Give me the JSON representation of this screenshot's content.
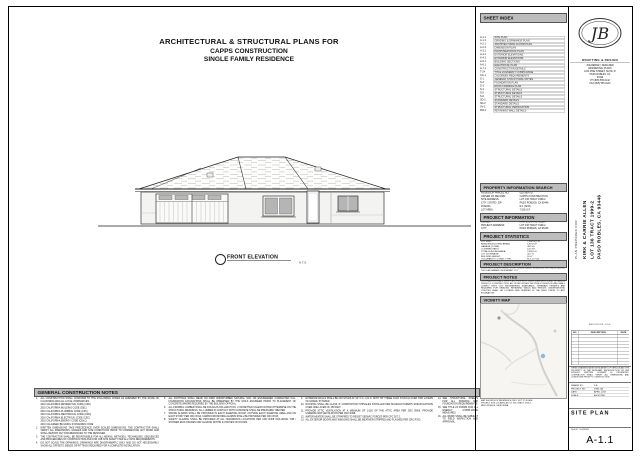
{
  "title_block": {
    "line1": "ARCHITECTURAL & STRUCTURAL PLANS FOR",
    "line2": "CAPPS CONSTRUCTION",
    "line3": "SINGLE FAMILY RESIDENCE"
  },
  "elevation": {
    "label": "FRONT ELEVATION",
    "scale_note": "N.T.S."
  },
  "sheet_index": {
    "header": "SHEET INDEX",
    "rows": [
      {
        "no": "A-1.1",
        "title": "SITE PLAN"
      },
      {
        "no": "A-1.2",
        "title": "GRADING & DRAINAGE PLAN"
      },
      {
        "no": "A-2.1",
        "title": "ARCHITECTURAL FLOOR PLAN"
      },
      {
        "no": "A-2.2",
        "title": "DIMENSION PLAN"
      },
      {
        "no": "A-3.1",
        "title": "PROPOSED ROOF PLAN"
      },
      {
        "no": "A-4.1",
        "title": "EXTERIOR ELEVATIONS"
      },
      {
        "no": "A-4.2",
        "title": "EXTERIOR ELEVATIONS"
      },
      {
        "no": "A-5.1",
        "title": "BUILDING SECTIONS"
      },
      {
        "no": "A-6.1",
        "title": "ELECTRICAL PLAN"
      },
      {
        "no": "A-7.1",
        "title": "CONSTRUCTION DETAILS"
      },
      {
        "no": "T-24",
        "title": "TITLE 24 ENERGY COMPLIANCE"
      },
      {
        "no": "CG-1",
        "title": "CALGREEN REQUIREMENTS"
      },
      {
        "no": "S-1",
        "title": "GENERAL STRUCTURAL NOTES"
      },
      {
        "no": "S-2",
        "title": "FOUNDATION PLAN"
      },
      {
        "no": "S-3",
        "title": "ROOF FRAMING PLAN"
      },
      {
        "no": "S-4",
        "title": "STRUCTURAL DETAILS"
      },
      {
        "no": "S-5",
        "title": "STRUCTURAL DETAILS"
      },
      {
        "no": "S-6",
        "title": "STRUCTURAL DETAILS"
      },
      {
        "no": "SD-1",
        "title": "STANDARD DETAILS"
      },
      {
        "no": "SD-2",
        "title": "STANDARD DETAILS"
      },
      {
        "no": "SV-1",
        "title": "STRUCTURAL VERIFICATION"
      },
      {
        "no": "RW-1",
        "title": "RETAINING WALL DETAILS"
      }
    ]
  },
  "logo": {
    "monogram": "JB",
    "firm": "DRAFTING & DESIGN",
    "address": "JOE BERKEY, DESIGNER\nRESIDENTIAL PLANS\n1234 PINE STREET, SUITE 'D'\nPASO ROBLES, CA\n93446\nPH (805) 555-0142\nFAX (805) 555-0143"
  },
  "prepared_for": {
    "label": "PLAN PREPARED FOR",
    "lines": [
      "KIRK & CARRIE ALLEN",
      "LOT 136 TRACT 1999-2",
      "PASO ROBLES, CA 93446"
    ]
  },
  "property_search": {
    "header": "PROPERTY INFORMATION SEARCH",
    "rows": [
      {
        "label": "ASSESSOR PARCEL NO:",
        "value": "025-380-017"
      },
      {
        "label": "OWNER OF RECORD:",
        "value": "CAPPS CONSTRUCTION"
      },
      {
        "label": "SITE ADDRESS:",
        "value": "LOT 136 TRACT 1999-2"
      },
      {
        "label": "CITY / STATE / ZIP:",
        "value": "PASO ROBLES, CA 93446"
      },
      {
        "label": "ZONING:",
        "value": "R-1 (SFR)"
      },
      {
        "label": "LOT AREA:",
        "value": "7,500 S.F."
      }
    ]
  },
  "project_info": {
    "header": "PROJECT INFORMATION",
    "rows": [
      {
        "label": "OWNER:",
        "value": "KIRK & CARRIE ALLEN"
      },
      {
        "label": "PROJECT ADDRESS:",
        "value": "LOT 136 TRACT 1999-2"
      },
      {
        "label": "CITY:",
        "value": "PASO ROBLES, CA 93446"
      }
    ]
  },
  "project_stats": {
    "header": "PROJECT STATISTICS",
    "rows": [
      {
        "label": "LOT SIZE:",
        "value": "7,500 SQ. FT."
      },
      {
        "label": "RESIDENCE (LIVING AREA):",
        "value": "1,874 S.F."
      },
      {
        "label": "GARAGE (2-CAR):",
        "value": "462 S.F."
      },
      {
        "label": "COVERED PATIO:",
        "value": "120 S.F."
      },
      {
        "label": "TOTAL BUILDING AREA:",
        "value": "2,456 S.F."
      },
      {
        "label": "LOT COVERAGE:",
        "value": "32.7 %"
      },
      {
        "label": "BUILDING HEIGHT:",
        "value": "16'-0\""
      },
      {
        "label": "OCCUPANCY / CONST. TYPE:",
        "value": "R-3, U / V-B"
      }
    ]
  },
  "project_description": {
    "header": "PROJECT DESCRIPTION",
    "text": "CONSTRUCT A NEW SINGLE STORY SINGLE FAMILY RESIDENCE WITH AN ATTACHED TWO CAR GARAGE ON A VACANT LOT."
  },
  "project_notes": {
    "header": "PROJECT NOTES",
    "text": "CONTRACTOR SHALL VERIFY ALL PROPERTY LINES, EASEMENTS AND SETBACKS PRIOR TO CONSTRUCTION. ALL WORK WITHIN THE PUBLIC RIGHT-OF-WAY SHALL COMPLY WITH CITY ENGINEERING STANDARDS. SEPARATE PERMITS ARE REQUIRED FOR GRADING, RETAINING WALLS AND FENCES. UNDERGROUND UTILITIES SHALL BE LOCATED AND VERIFIED IN THE FIELD PRIOR TO ANY EXCAVATION."
  },
  "vicinity_map": {
    "header": "VICINITY MAP",
    "caption": "MAP SHOWN FOR REFERENCE ONLY. NOT TO SCALE.\nPROJECT SITE LOCATED AT LOT 136, TRACT 1999-2,\nPASO ROBLES, CALIFORNIA.",
    "marker_color": "#8fb8dc"
  },
  "revisions": {
    "title": "REVISION LOG",
    "columns": [
      "NO.",
      "DESCRIPTION",
      "DATE"
    ],
    "rows": [
      "",
      "",
      "",
      "",
      "",
      "",
      "",
      "",
      "",
      ""
    ]
  },
  "title_strip": {
    "disclaimer": "THESE DRAWINGS ARE INSTRUMENTS OF SERVICE AND THE PROPERTY OF THE DESIGNER. REPRODUCTION OR USE WITHOUT WRITTEN CONSENT IS PROHIBITED. CONTRACTOR SHALL VERIFY ALL DIMENSIONS AND CONDITIONS PRIOR TO CONSTRUCTION.",
    "fields": [
      {
        "label": "DRAWN BY:",
        "value": "J.B."
      },
      {
        "label": "PROJECT NO:",
        "value": "1999-136"
      },
      {
        "label": "DATE:",
        "value": "APRIL 2018"
      },
      {
        "label": "SCALE:",
        "value": "AS NOTED"
      }
    ],
    "sheet_title": "SITE PLAN",
    "sheet_number_label": "SHEET NUMBER",
    "sheet_number": "A-1.1"
  },
  "general_notes": {
    "header": "GENERAL CONSTRUCTION NOTES",
    "col1": [
      {
        "n": "1.",
        "t": "ALL CONSTRUCTION SHALL CONFORM TO THE FOLLOWING CODES AS AMENDED BY THE STATE OF CALIFORNIA AND ALL LOCAL ORDINANCES:"
      },
      {
        "n": "",
        "t": "2016 CALIFORNIA RESIDENTIAL CODE (CRC)"
      },
      {
        "n": "",
        "t": "2016 CALIFORNIA BUILDING CODE (CBC)"
      },
      {
        "n": "",
        "t": "2016 CALIFORNIA PLUMBING CODE (CPC)"
      },
      {
        "n": "",
        "t": "2016 CALIFORNIA MECHANICAL CODE (CMC)"
      },
      {
        "n": "",
        "t": "2016 CALIFORNIA ELECTRICAL CODE (CEC)"
      },
      {
        "n": "",
        "t": "2016 CALIFORNIA ENERGY CODE (CEnC)"
      },
      {
        "n": "",
        "t": "2016 CALGREEN BUILDING STANDARDS CODE"
      },
      {
        "n": "2.",
        "t": "WRITTEN DIMENSIONS TAKE PRECEDENCE OVER SCALED DIMENSIONS. THE CONTRACTOR SHALL VERIFY ALL DIMENSIONS, GRADES AND SITE CONDITIONS PRIOR TO COMMENCING ANY WORK AND SHALL REPORT ANY DISCREPANCIES TO THE DESIGNER."
      },
      {
        "n": "3.",
        "t": "THE CONTRACTOR SHALL BE RESPONSIBLE FOR ALL MEANS, METHODS, TECHNIQUES, SEQUENCES AND PROCEDURES OF CONSTRUCTION AND FOR JOB SITE SAFETY PER ALL OSHA REQUIREMENTS."
      },
      {
        "n": "4.",
        "t": "DO NOT SCALE THE DRAWINGS. DRAWINGS ARE DIAGRAMMATIC ONLY AND DO NOT NECESSARILY SHOW ALL OFFSETS, BENDS OR FITTINGS REQUIRED FOR A COMPLETE INSTALLATION."
      }
    ],
    "col2": [
      {
        "n": "5.",
        "t": "ALL FOOTINGS SHALL BEAR ON FIRM UNDISTURBED NATURAL SOIL OR ENGINEERED COMPACTED FILL. FOUNDATION EXCAVATIONS SHALL BE OBSERVED BY THE SOILS ENGINEER PRIOR TO PLACEMENT OF CONCRETE WHERE REQUIRED BY THE BUILDING OFFICIAL."
      },
      {
        "n": "6.",
        "t": "ALL FRAMING LUMBER SHALL BE DOUGLAS FIR-LARCH NO. 2 OR BETTER UNLESS NOTED OTHERWISE ON THE STRUCTURAL DRAWINGS. ALL LUMBER IN CONTACT WITH CONCRETE SHALL BE PRESSURE TREATED."
      },
      {
        "n": "7.",
        "t": "SMOKE ALARMS SHALL BE PROVIDED IN EACH SLEEPING ROOM, OUTSIDE EACH SLEEPING AREA AND ON EACH STORY PER CRC R314. CARBON MONOXIDE ALARMS SHALL BE PROVIDED PER CRC R315."
      },
      {
        "n": "8.",
        "t": "SAFETY GLAZING SHALL BE PROVIDED AT ALL HAZARDOUS LOCATIONS PER CRC R308 INCLUDING TUB / SHOWER ENCLOSURES AND GLAZING WITHIN 24 INCHES OF DOORS."
      }
    ],
    "col3": [
      {
        "n": "9.",
        "t": "EXTERIOR WALLS SHALL BE 2X4 STUDS AT 16\" O.C. U.N.O. WITH 7/8\" THREE COAT STUCCO OVER TWO LAYERS OF GRADE 'D' PAPER."
      },
      {
        "n": "10.",
        "t": "ROOFING SHALL BE CLASS 'A' COMPOSITION SHINGLES INSTALLED PER MANUFACTURER'S SPECIFICATIONS OVER ONE LAYER OF 15# FELT."
      },
      {
        "n": "11.",
        "t": "PROVIDE ATTIC VENTILATION AT A MINIMUM OF 1/150 OF THE ATTIC AREA PER CRC R806. PROVIDE UNDERFLOOR VENTILATION PER CRC R408."
      },
      {
        "n": "12.",
        "t": "WATER HEATER SHALL BE STRAPPED TO RESIST SEISMIC FORCES PER CPC 507.2."
      },
      {
        "n": "13.",
        "t": "ALL EXTERIOR DOORS AND WINDOWS SHALL BE WEATHER-STRIPPED AND FLASHED PER CRC R703."
      }
    ],
    "col4": [
      {
        "n": "14.",
        "t": "SEE STRUCTURAL SHEETS FOR ALL FRAMING AND FOUNDATION REQUIREMENTS."
      },
      {
        "n": "15.",
        "t": "SEE TITLE 24 FORMS FOR ALL ENERGY COMPLIANCE MEASURES."
      },
      {
        "n": "16.",
        "t": "ALL WORK SHALL BE SUBJECT TO FIELD INSPECTION AND APPROVAL."
      }
    ]
  }
}
